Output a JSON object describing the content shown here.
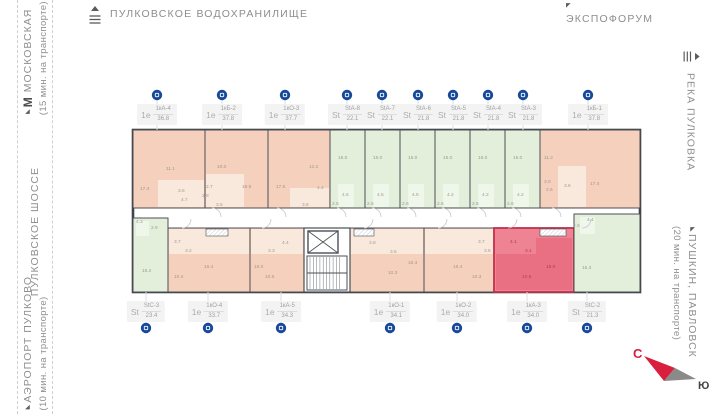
{
  "landmarks": {
    "reservoir": {
      "label": "ПУЛКОВСКОЕ  ВОДОХРАНИЛИЩЕ"
    },
    "expoforum": {
      "label": "ЭКСПОФОРУМ"
    },
    "metro": {
      "prefix": "М",
      "label": " МОСКОВСКАЯ",
      "note": "(15 мин. на транспорте)"
    },
    "highway": {
      "label": "ПУЛКОВСКОЕ  ШОССЕ"
    },
    "airport": {
      "label": "АЭРОПОРТ  ПУЛКОВО",
      "note": "(10 мин. на транспорте)"
    },
    "river": {
      "label": "РЕКА  ПУЛКОВКА"
    },
    "pushkin": {
      "label": "ПУШКИН,  ПАВЛОВСК",
      "note": "(20 мин. на транспорте)"
    }
  },
  "compass": {
    "north": "С",
    "south": "Ю"
  },
  "selected_unit": "1кА-3",
  "units": {
    "top": [
      {
        "type": "1е",
        "code": "1кА-4",
        "area": "36.8",
        "pin_x": 157
      },
      {
        "type": "1е",
        "code": "1кБ-2",
        "area": "37.8",
        "pin_x": 222
      },
      {
        "type": "1е",
        "code": "1кО-3",
        "area": "37.7",
        "pin_x": 285
      },
      {
        "type": "St",
        "code": "StА-8",
        "area": "22.1",
        "pin_x": 347
      },
      {
        "type": "St",
        "code": "StА-7",
        "area": "22.1",
        "pin_x": 382
      },
      {
        "type": "St",
        "code": "StА-6",
        "area": "21.8",
        "pin_x": 418
      },
      {
        "type": "St",
        "code": "StА-5",
        "area": "21.8",
        "pin_x": 453
      },
      {
        "type": "St",
        "code": "StА-4",
        "area": "21.8",
        "pin_x": 488
      },
      {
        "type": "St",
        "code": "StА-3",
        "area": "21.8",
        "pin_x": 523
      },
      {
        "type": "1е",
        "code": "1кБ-1",
        "area": "37.8",
        "pin_x": 588
      }
    ],
    "bottom": [
      {
        "type": "St",
        "code": "StС-3",
        "area": "23.4",
        "pin_x": 146
      },
      {
        "type": "1е",
        "code": "1кО-4",
        "area": "33.7",
        "pin_x": 208
      },
      {
        "type": "1е",
        "code": "1кА-5",
        "area": "34.3",
        "pin_x": 281
      },
      {
        "type": "1е",
        "code": "1кО-1",
        "area": "34.1",
        "pin_x": 390
      },
      {
        "type": "1е",
        "code": "1кО-2",
        "area": "34.0",
        "pin_x": 457
      },
      {
        "type": "1е",
        "code": "1кА-3",
        "area": "34.0",
        "pin_x": 527,
        "selected": true
      },
      {
        "type": "St",
        "code": "StС-2",
        "area": "21.3",
        "pin_x": 587
      }
    ]
  },
  "floorplan": {
    "colors": {
      "wall": "#4b4f55",
      "outline": "#3f434a",
      "salmon": "#f4d0bd",
      "salmon_light": "#f9e9dd",
      "green": "#e3efda",
      "green_light": "#eff6ea",
      "highlight": "#ee8394",
      "highlight_dark": "#e97083",
      "highlight_stroke": "#c2314e",
      "pin": "#17499b"
    },
    "units": [
      {
        "id": "1кА-4",
        "x": 1,
        "y": 4,
        "w": 72,
        "h": 78,
        "fill": "salmon"
      },
      {
        "id": "1кБ-2",
        "x": 73,
        "y": 4,
        "w": 63,
        "h": 78,
        "fill": "salmon"
      },
      {
        "id": "1кО-3",
        "x": 136,
        "y": 4,
        "w": 62,
        "h": 78,
        "fill": "salmon"
      },
      {
        "id": "StА-8",
        "x": 198,
        "y": 4,
        "w": 35,
        "h": 78,
        "fill": "green"
      },
      {
        "id": "StА-7",
        "x": 233,
        "y": 4,
        "w": 35,
        "h": 78,
        "fill": "green"
      },
      {
        "id": "StА-6",
        "x": 268,
        "y": 4,
        "w": 35,
        "h": 78,
        "fill": "green"
      },
      {
        "id": "StА-5",
        "x": 303,
        "y": 4,
        "w": 35,
        "h": 78,
        "fill": "green"
      },
      {
        "id": "StА-4",
        "x": 338,
        "y": 4,
        "w": 35,
        "h": 78,
        "fill": "green"
      },
      {
        "id": "StА-3",
        "x": 373,
        "y": 4,
        "w": 35,
        "h": 78,
        "fill": "green"
      },
      {
        "id": "1кБ-1",
        "x": 408,
        "y": 4,
        "w": 100,
        "h": 78,
        "fill": "salmon"
      },
      {
        "id": "StС-3",
        "x": 1,
        "y": 92,
        "w": 35,
        "h": 74,
        "fill": "green"
      },
      {
        "id": "1кО-4",
        "x": 36,
        "y": 102,
        "w": 82,
        "h": 64,
        "fill": "salmon"
      },
      {
        "id": "1кА-5",
        "x": 118,
        "y": 102,
        "w": 54,
        "h": 64,
        "fill": "salmon"
      },
      {
        "id": "1кО-1",
        "x": 218,
        "y": 102,
        "w": 74,
        "h": 64,
        "fill": "salmon"
      },
      {
        "id": "1кО-2",
        "x": 292,
        "y": 102,
        "w": 70,
        "h": 64,
        "fill": "salmon"
      },
      {
        "id": "1кА-3",
        "x": 362,
        "y": 102,
        "w": 80,
        "h": 64,
        "fill": "highlight",
        "selected": true
      },
      {
        "id": "StС-2",
        "x": 442,
        "y": 88,
        "w": 66,
        "h": 78,
        "fill": "green"
      }
    ],
    "shades": [
      {
        "x": 26,
        "y": 54,
        "w": 46,
        "h": 27,
        "f": "salmon_light"
      },
      {
        "x": 74,
        "y": 48,
        "w": 38,
        "h": 33,
        "f": "salmon_light"
      },
      {
        "x": 158,
        "y": 62,
        "w": 39,
        "h": 19,
        "f": "salmon_light"
      },
      {
        "x": 426,
        "y": 40,
        "w": 28,
        "h": 41,
        "f": "salmon_light"
      },
      {
        "x": 206,
        "y": 58,
        "w": 16,
        "h": 23,
        "f": "green_light"
      },
      {
        "x": 241,
        "y": 58,
        "w": 16,
        "h": 23,
        "f": "green_light"
      },
      {
        "x": 276,
        "y": 58,
        "w": 16,
        "h": 23,
        "f": "green_light"
      },
      {
        "x": 311,
        "y": 58,
        "w": 16,
        "h": 23,
        "f": "green_light"
      },
      {
        "x": 346,
        "y": 58,
        "w": 16,
        "h": 23,
        "f": "green_light"
      },
      {
        "x": 381,
        "y": 58,
        "w": 16,
        "h": 23,
        "f": "green_light"
      },
      {
        "x": 4,
        "y": 95,
        "w": 13,
        "h": 15,
        "f": "green_light"
      },
      {
        "x": 448,
        "y": 91,
        "w": 15,
        "h": 17,
        "f": "green_light"
      },
      {
        "x": 37,
        "y": 103,
        "w": 80,
        "h": 25,
        "f": "salmon_light"
      },
      {
        "x": 119,
        "y": 103,
        "w": 52,
        "h": 25,
        "f": "salmon_light"
      },
      {
        "x": 219,
        "y": 103,
        "w": 72,
        "h": 25,
        "f": "salmon_light"
      },
      {
        "x": 293,
        "y": 103,
        "w": 68,
        "h": 25,
        "f": "salmon_light"
      },
      {
        "x": 364,
        "y": 128,
        "w": 40,
        "h": 36,
        "f": "highlight_dark"
      },
      {
        "x": 404,
        "y": 112,
        "w": 36,
        "h": 52,
        "f": "highlight_dark"
      }
    ],
    "room_labels": [
      [
        "17.4",
        8,
        64
      ],
      [
        "11.1",
        34,
        44
      ],
      [
        "3.6",
        46,
        66
      ],
      [
        "4.7",
        49,
        75
      ],
      [
        "10.0",
        85,
        42
      ],
      [
        "2.7",
        74,
        62
      ],
      [
        "2.8",
        70,
        71
      ],
      [
        "3.5",
        84,
        80
      ],
      [
        "18.8",
        110,
        62
      ],
      [
        "17.5",
        144,
        62
      ],
      [
        "12.2",
        177,
        42
      ],
      [
        "4.4",
        185,
        63
      ],
      [
        "3.6",
        170,
        80
      ],
      [
        "15.0",
        206,
        33
      ],
      [
        "4.5",
        210,
        70
      ],
      [
        "2.6",
        200,
        79
      ],
      [
        "15.0",
        241,
        33
      ],
      [
        "4.5",
        245,
        70
      ],
      [
        "2.6",
        235,
        79
      ],
      [
        "15.0",
        276,
        33
      ],
      [
        "4.5",
        280,
        70
      ],
      [
        "2.6",
        270,
        79
      ],
      [
        "15.0",
        311,
        33
      ],
      [
        "4.2",
        315,
        70
      ],
      [
        "2.6",
        305,
        79
      ],
      [
        "15.0",
        346,
        33
      ],
      [
        "4.2",
        350,
        70
      ],
      [
        "2.6",
        340,
        79
      ],
      [
        "15.0",
        381,
        33
      ],
      [
        "4.2",
        385,
        70
      ],
      [
        "2.6",
        375,
        79
      ],
      [
        "11.2",
        412,
        33
      ],
      [
        "3.0",
        412,
        57
      ],
      [
        "2.6",
        414,
        65
      ],
      [
        "3.6",
        432,
        61
      ],
      [
        "17.4",
        458,
        59
      ],
      [
        "4.3",
        4,
        97
      ],
      [
        "2.9",
        19,
        103
      ],
      [
        "16.2",
        10,
        146
      ],
      [
        "3.7",
        42,
        117
      ],
      [
        "3.2",
        53,
        126
      ],
      [
        "10.4",
        42,
        152
      ],
      [
        "16.4",
        72,
        142
      ],
      [
        "16.0",
        122,
        142
      ],
      [
        "3.3",
        136,
        126
      ],
      [
        "10.6",
        133,
        152
      ],
      [
        "4.4",
        150,
        118
      ],
      [
        "3.8",
        237,
        118
      ],
      [
        "3.6",
        258,
        127
      ],
      [
        "16.4",
        276,
        138
      ],
      [
        "10.3",
        256,
        148
      ],
      [
        "3.7",
        346,
        117
      ],
      [
        "3.6",
        352,
        126
      ],
      [
        "16.4",
        321,
        142
      ],
      [
        "10.3",
        340,
        152
      ],
      [
        "4.1",
        378,
        117,
        "r"
      ],
      [
        "3.1",
        393,
        126,
        "r"
      ],
      [
        "10.6",
        390,
        152,
        "r"
      ],
      [
        "16.0",
        414,
        142,
        "r"
      ],
      [
        "4.4",
        455,
        95
      ],
      [
        "2.9",
        441,
        101
      ],
      [
        "16.3",
        450,
        143
      ]
    ]
  }
}
